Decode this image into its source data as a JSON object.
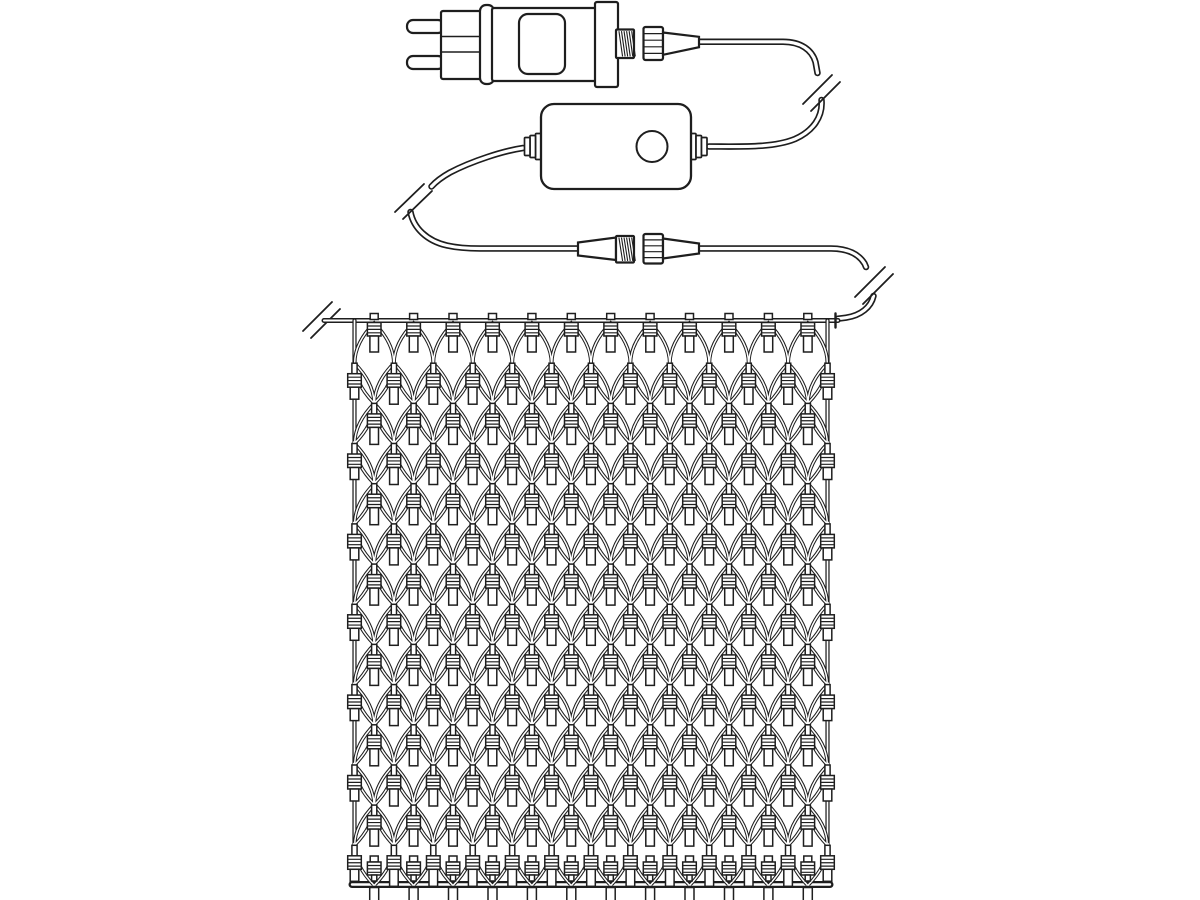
{
  "diagram": {
    "description": "line-art-diagram-of-net-string-lights-with-plug-controller-and-connectors",
    "colors": {
      "background": "#ffffff",
      "line": "#1e1e1e",
      "fill": "#ffffff"
    },
    "canvas": {
      "width": 1200,
      "height": 900
    },
    "plug": {
      "prongs": [
        [
          407,
          20,
          37,
          13
        ],
        [
          407,
          56,
          37,
          13
        ]
      ],
      "front": {
        "x": 441,
        "y": 11,
        "w": 43,
        "h": 68,
        "lines": [
          36.5,
          52
        ]
      },
      "collar": {
        "x": 480,
        "y": 5,
        "w": 14,
        "h": 79
      },
      "body": {
        "x": 492,
        "y": 8,
        "w": 105,
        "h": 73
      },
      "label": {
        "x": 519,
        "y": 14,
        "w": 46,
        "h": 60,
        "r": 9
      },
      "flange": {
        "x": 595,
        "y": 2,
        "w": 23,
        "h": 85
      },
      "thread": {
        "x": 616,
        "y": 29.5,
        "w": 18,
        "h": 28.5
      },
      "cap": {
        "x": 643.5,
        "y": 27,
        "w": 19.5,
        "h": 33
      },
      "taper": [
        [
          663,
          32.5
        ],
        [
          699,
          36.8
        ],
        [
          699,
          47.2
        ],
        [
          663,
          54.8
        ]
      ]
    },
    "controller": {
      "box": {
        "x": 541,
        "y": 104,
        "w": 150,
        "h": 85,
        "r": 13
      },
      "button": {
        "cx": 652,
        "cy": 146.5,
        "r": 15.5
      },
      "grommet_left": [
        [
          535.5,
          133.5,
          5.5,
          26
        ],
        [
          530,
          135.5,
          5.5,
          22
        ],
        [
          524.5,
          137.5,
          5.5,
          18
        ]
      ],
      "grommet_right": [
        [
          690.5,
          133.5,
          5.5,
          26
        ],
        [
          696,
          135.5,
          5.5,
          22
        ],
        [
          701.5,
          137.5,
          5.5,
          18
        ]
      ]
    },
    "connector": {
      "male_taper": [
        [
          578,
          242.5
        ],
        [
          616,
          237.5
        ],
        [
          616,
          260
        ],
        [
          578,
          255.5
        ]
      ],
      "thread": {
        "x": 616,
        "y": 236,
        "w": 18,
        "h": 26.5
      },
      "cap": {
        "x": 643.5,
        "y": 234,
        "w": 19.5,
        "h": 29.5
      },
      "taper": [
        [
          663,
          238.5
        ],
        [
          699,
          243.5
        ],
        [
          699,
          253.5
        ],
        [
          663,
          258.5
        ]
      ]
    },
    "cables": {
      "segments": [
        {
          "name": "plug-cable",
          "d": "M698,41.8 H783 C801,41.8 812,50 815.5,62 L817.5,73"
        },
        {
          "name": "cable-to-controller",
          "d": "M821.5,100 C823,117 813,131 795,139 C773,148 741,146.5 709,146.5"
        },
        {
          "name": "controller-left-cable",
          "d": "M523,148 C503,151 472,161 450,172.5 C442,177 436,181.5 431.5,186.5"
        },
        {
          "name": "cable-to-connector",
          "d": "M410.5,212 C413.5,228 427,241 447,245.5 C456,247.5 468,248.5 480,248.5 L579,248.5"
        },
        {
          "name": "connector-right-cable",
          "d": "M698,248.5 H831 C848,248.5 859,254.5 864.5,263.5 L866,267"
        },
        {
          "name": "cable-to-net",
          "d": "M873.5,296 C871,307 861,315.5 846,317.7 L838,318.7"
        }
      ],
      "breaks": [
        {
          "name": "cable-break-plug",
          "lines": [
            [
              803,
              104,
              832,
              75
            ],
            [
              811,
              111,
              840,
              82
            ]
          ]
        },
        {
          "name": "cable-break-controller",
          "lines": [
            [
              395,
              212,
              424,
              184
            ],
            [
              403,
              219,
              432,
              191
            ]
          ]
        },
        {
          "name": "cable-break-connector",
          "lines": [
            [
              855,
              297,
              885,
              267
            ],
            [
              863,
              304,
              893,
              274
            ]
          ]
        },
        {
          "name": "cable-break-net-wire",
          "lines": [
            [
              303,
              331,
              332,
              302
            ],
            [
              311,
              338,
              340,
              309
            ]
          ]
        }
      ]
    },
    "net": {
      "left": 354.5,
      "right": 827.5,
      "top_wire_y": 320.5,
      "bottom_wire_y": 884.5,
      "wire_left_x": 324,
      "wire_right_x": 838,
      "end_cap_x": 835.5,
      "columns": 12,
      "node_rows": 15,
      "row_y0": 322,
      "row_pitch": 40.179,
      "mesh_ctrl": 26,
      "lamp_total": 187
    },
    "strokes": {
      "cable_outer": 6.5,
      "cable_inner": 3.2,
      "top_wire_outer": 5,
      "top_wire_inner": 2,
      "edge_outer": 4.2,
      "edge_inner": 1.7,
      "bottom_outer": 7,
      "bottom_inner": 2.4,
      "mesh_outer": 3.6,
      "mesh_inner": 1.5,
      "body": 2.2,
      "lamp": 1.5,
      "rib": 1.2,
      "slash": 1.8
    }
  }
}
